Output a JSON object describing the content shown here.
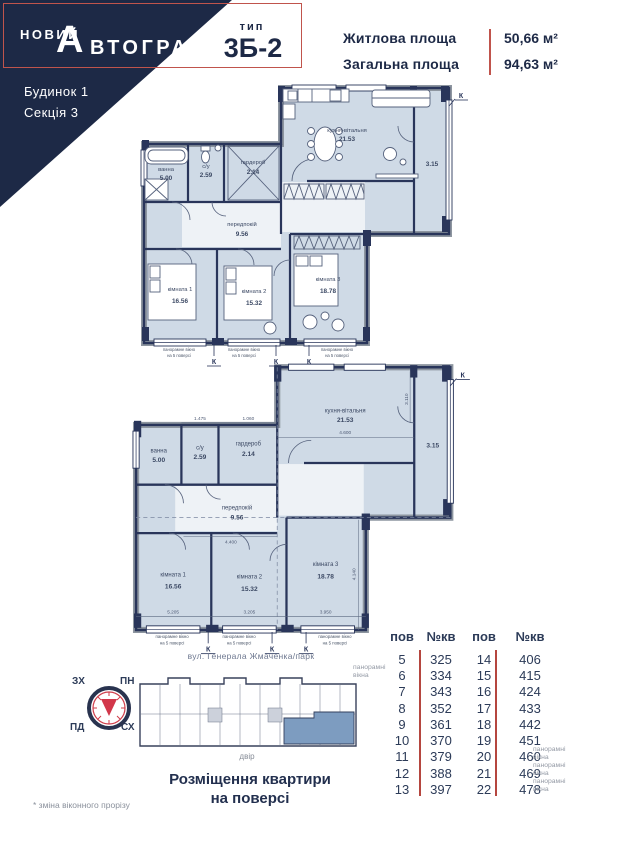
{
  "header": {
    "brand_top": "НОВИЙ",
    "brand_initial": "А",
    "brand_rest": "ВТОГРАФ",
    "type_label": "тип",
    "type_value": "3Б-2",
    "living_label": "Житлова площа",
    "living_value": "50,66 м²",
    "total_label": "Загальна площа",
    "total_value": "94,63 м²",
    "building": "Будинок 1",
    "section": "Секція 3"
  },
  "plan": {
    "rooms": {
      "kitchen": {
        "name": "кухня-вітальня",
        "area": "21.53"
      },
      "balcony": {
        "area": "3.15"
      },
      "bath": {
        "name": "ванна",
        "area": "5.00"
      },
      "wc": {
        "name": "с/у",
        "area": "2.59"
      },
      "wardrobe": {
        "name": "гардероб",
        "area": "2.14"
      },
      "hall": {
        "name": "передпокій",
        "area": "9.56"
      },
      "room1": {
        "name": "кімната 1",
        "area": "16.56"
      },
      "room2": {
        "name": "кімната 2",
        "area": "15.32"
      },
      "room3": {
        "name": "кімната 3",
        "area": "18.78"
      }
    },
    "k_mark": "К",
    "window_note": {
      "line1": "панорамне вікно",
      "line2": "на 5 поверсі"
    },
    "dims": [
      "1.475",
      "1.060",
      "4.600",
      "3.110",
      "4.400",
      "5.205",
      "3.205",
      "3.950",
      "4.140"
    ]
  },
  "legend": {
    "street": "вул. Генерала Жмаченка/парк",
    "yard": "двір",
    "caption1": "Розміщення квартири",
    "caption2": "на поверсі",
    "footnote": "* зміна віконного прорізу",
    "compass": {
      "nw": "ЗХ",
      "ne": "ПН",
      "sw": "ПД",
      "se": "СХ"
    }
  },
  "table": {
    "headers": [
      "пов",
      "№кв",
      "пов",
      "№кв"
    ],
    "rows": [
      {
        "f1": "5",
        "a1": "325",
        "f2": "14",
        "a2": "406"
      },
      {
        "f1": "6",
        "a1": "334",
        "f2": "15",
        "a2": "415"
      },
      {
        "f1": "7",
        "a1": "343",
        "f2": "16",
        "a2": "424"
      },
      {
        "f1": "8",
        "a1": "352",
        "f2": "17",
        "a2": "433"
      },
      {
        "f1": "9",
        "a1": "361",
        "f2": "18",
        "a2": "442"
      },
      {
        "f1": "10",
        "a1": "370",
        "f2": "19",
        "a2": "451"
      },
      {
        "f1": "11",
        "a1": "379",
        "f2": "20",
        "a2": "460"
      },
      {
        "f1": "12",
        "a1": "388",
        "f2": "21",
        "a2": "469"
      },
      {
        "f1": "13",
        "a1": "397",
        "f2": "22",
        "a2": "478"
      }
    ],
    "note_line1": "панорамні",
    "note_line2": "вікна"
  }
}
